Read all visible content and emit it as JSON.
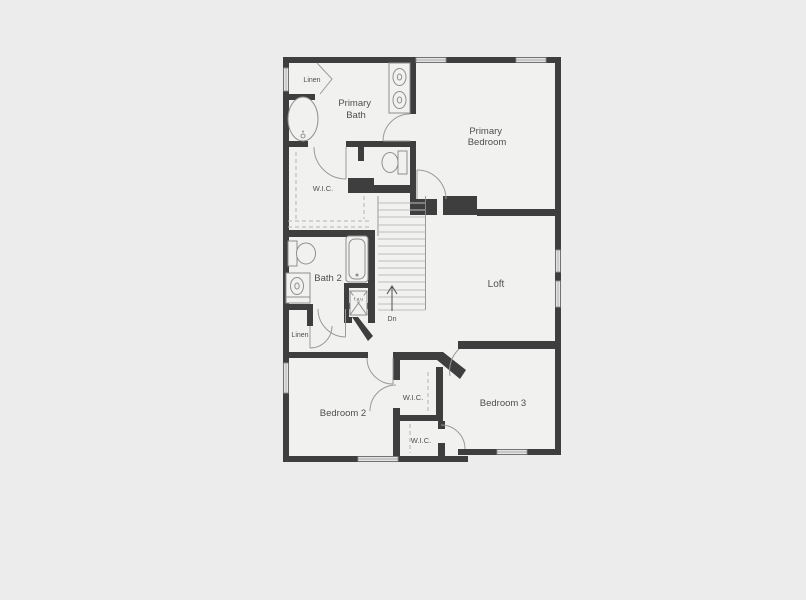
{
  "colors": {
    "bg": "#ececec",
    "floor": "#f1f1ef",
    "wall": "#3e3e3e",
    "fixture": "#8f8f8f",
    "door": "#9a9a9a",
    "dash": "#b3b3b3",
    "tread": "#bdbdbd",
    "text": "#4f4f4f"
  },
  "labels": {
    "linen_top": "Linen",
    "primary_bath": [
      "Primary",
      "Bath"
    ],
    "primary_bedroom": [
      "Primary",
      "Bedroom"
    ],
    "wic_primary": "W.I.C.",
    "bath2": "Bath 2",
    "fau": "f.a.u",
    "dn": "Dn",
    "loft": "Loft",
    "linen_hall": "Linen",
    "bedroom2": "Bedroom 2",
    "bedroom3": "Bedroom 3",
    "wic_bedroom2": "W.I.C.",
    "wic_bedroom3": "W.I.C."
  }
}
